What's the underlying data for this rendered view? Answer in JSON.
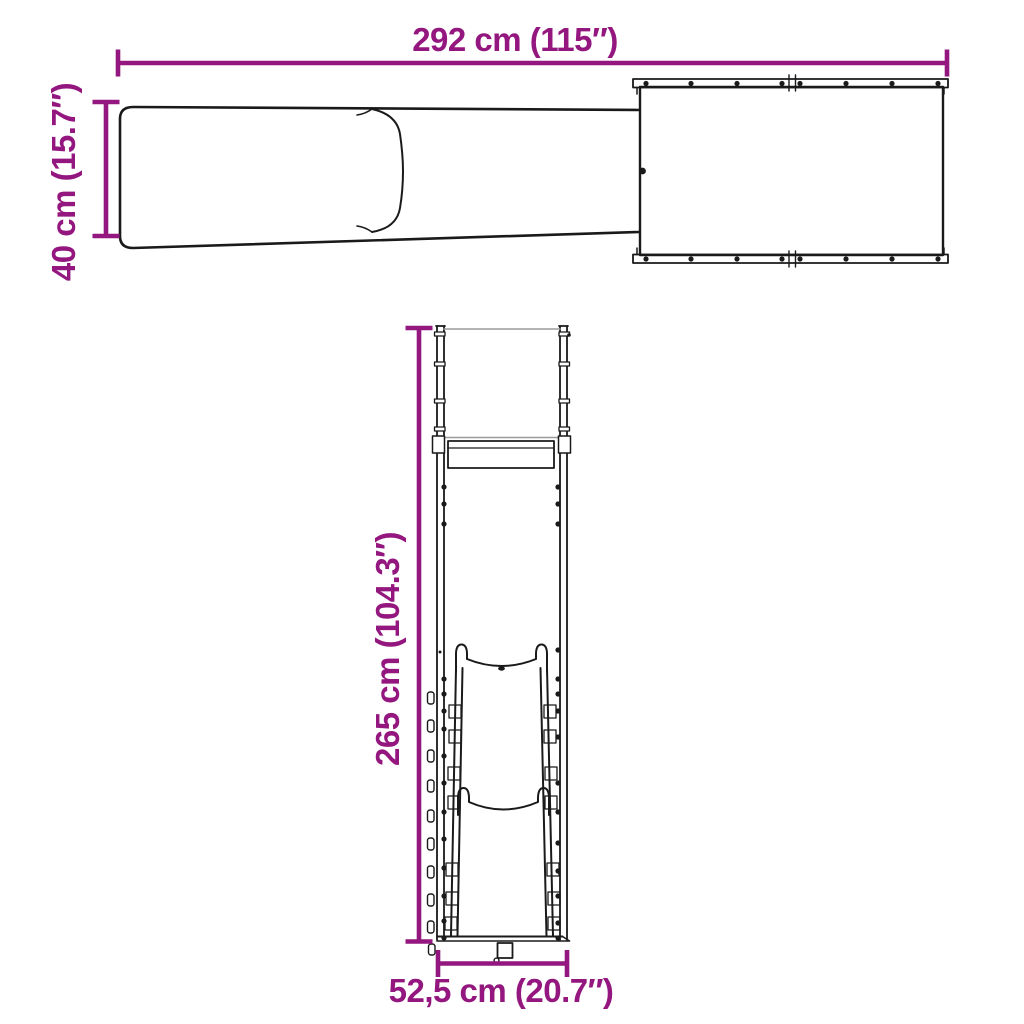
{
  "colors": {
    "accent": "#93177E",
    "line_art": "#1A1A1A",
    "background": "#FFFFFF"
  },
  "diagram": {
    "labels": {
      "horizontal_top": "292 cm (115″)",
      "vertical_left": "40 cm (15.7″)",
      "vertical_middle": "265 cm (104.3″)",
      "horizontal_bottom": "52,5 cm (20.7″)"
    }
  }
}
